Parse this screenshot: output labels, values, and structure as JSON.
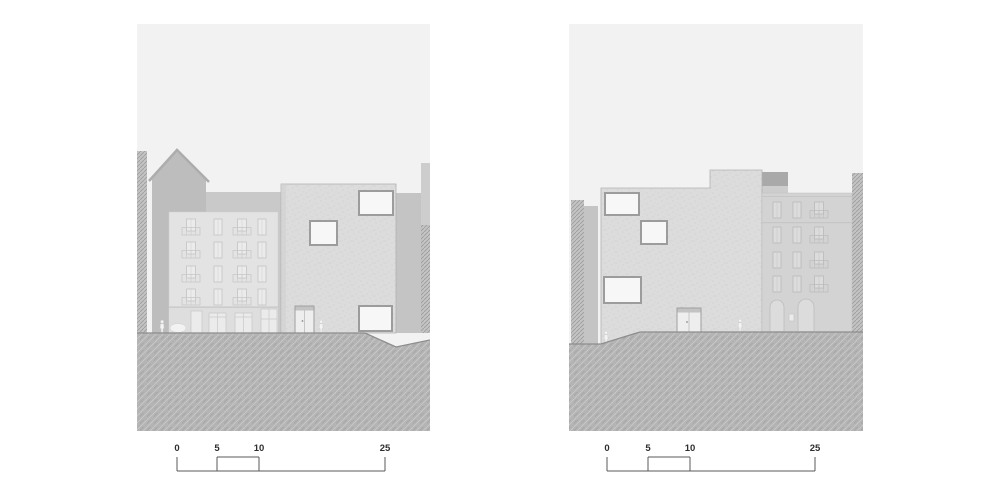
{
  "drawing": {
    "type": "architectural elevation sheet",
    "panel_count": 2
  },
  "scale_bar": {
    "labels": [
      "0",
      "5",
      "10",
      "25"
    ]
  },
  "palette": {
    "sky": "#f2f2f2",
    "ground_base": "#b4b4b4",
    "ground_hatch_light": "#c9c9c9",
    "ground_hatch_dark": "#a2a2a2",
    "ground_line": "#8d8d8d",
    "hatch_wall_bg": "#c3c3c3",
    "hatch_wall_line": "#9b9b9b",
    "house_body": "#bdbdbd",
    "house_roof_edge": "#adadad",
    "annex_block": "#c9c9c9",
    "background_block": "#c4c4c4",
    "side_block": "#cdcdcd",
    "dark_block": "#a9a9a9",
    "classical_left_facade": "#e3e3e3",
    "classical_right_facade": "#d3d3d3",
    "classical_ground_band": "#dedede",
    "classical_detail": "#c6c6c6",
    "modern_facade": "#dcdcdc",
    "modern_dot": "#c7c7c7",
    "modern_outline": "#b2b2b2",
    "window_frame": "#9c9c9c",
    "window_glass": "#f7f7f7",
    "door_frame": "#9f9f9f",
    "door_glass": "#eeeeee",
    "door_transom": "#c3c3c3",
    "figure_fill": "#f4f4f4",
    "figure_stroke": "#c8c8c8",
    "scalebar_line": "#595959",
    "scalebar_text": "#2e2e2e"
  }
}
